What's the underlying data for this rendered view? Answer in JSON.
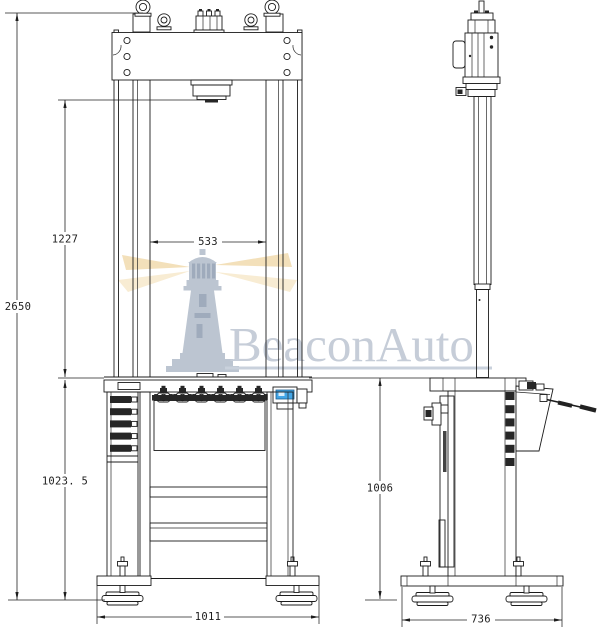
{
  "drawing": {
    "type": "engineering-dimension-drawing",
    "views": {
      "left": "front view",
      "right": "side view"
    },
    "dimensions": {
      "total_height": "2650",
      "daylight_opening": "1227",
      "column_clearance": "533",
      "table_height": "1023. 5",
      "base_width": "1011",
      "side_height": "1006",
      "side_depth": "736"
    },
    "watermark": {
      "brand": "BeaconAuto"
    },
    "colors": {
      "line": "#1c1c1c",
      "display_blue": "#42a5e6",
      "watermark_text": "#c6cdd8",
      "lighthouse_grey": "#bcc5d1",
      "ray_gold": "#f3e0ba",
      "background": "#ffffff"
    }
  }
}
